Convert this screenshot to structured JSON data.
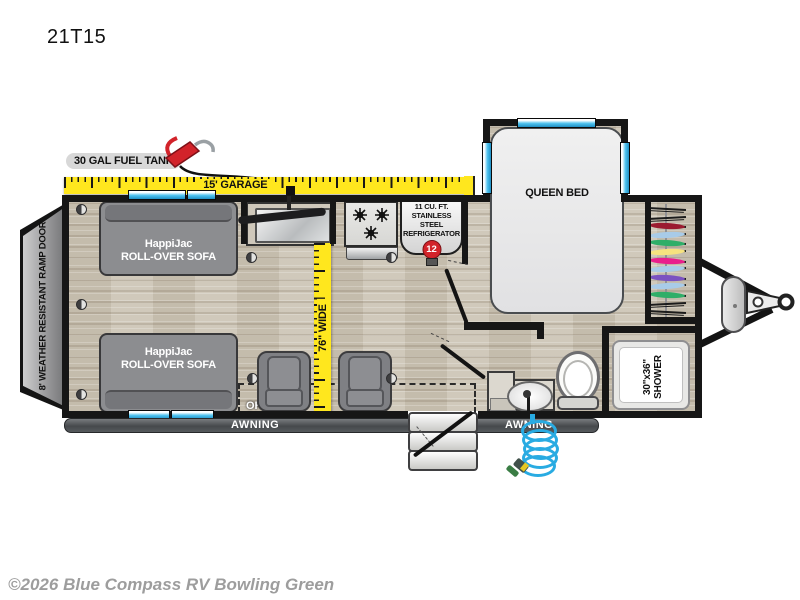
{
  "title": "21T15",
  "watermark": "©2026 Blue Compass RV Bowling Green",
  "exterior": {
    "fuel_tank_label": "30 GAL FUEL TANK",
    "garage_tape_label": "15' GARAGE",
    "ramp_door_label": "8' WEATHER RESISTANT RAMP DOOR",
    "awning_left_label": "AWNING",
    "awning_right_label": "AWNING"
  },
  "interior": {
    "width_tape_label": "76\" WIDE",
    "queen_bed_label": "QUEEN BED",
    "ohc_label": "OHC",
    "sofas": [
      {
        "line1": "HappiJac",
        "line2": "ROLL-OVER SOFA"
      },
      {
        "line1": "HappiJac",
        "line2": "ROLL-OVER SOFA"
      }
    ],
    "fridge": {
      "line1": "11 CU. FT.",
      "line2": "STAINLESS STEEL",
      "line3": "REFRIGERATOR",
      "badge": "12"
    },
    "shower": {
      "line1": "30\"x36\"",
      "line2": "SHOWER"
    }
  },
  "icons": {
    "fuel_nozzle": "fuel-pump-nozzle-icon",
    "fridge_badge": "12-volt-icon",
    "stove": "three-burner-stove-icon",
    "propane": "propane-tank-icon",
    "hitch": "tongue-coupler-icon",
    "steps": "entry-steps-icon",
    "hose": "coiled-spray-hose-icon"
  },
  "colors": {
    "tape_yellow": "#FFE71E",
    "accent_red": "#D2232A",
    "window_blue": "#4FC3F0",
    "hose_blue": "#29ABE2",
    "wall_black": "#161616",
    "floor_tan": "#CDC5B6",
    "sofa_gray": "#8C8D90",
    "awning_gray": "#46494C",
    "watermark_gray": "#9D9D9D"
  },
  "closet": {
    "hanger_colors": [
      "hanger",
      "hanger",
      "#9B1B30",
      "#A8CBE8",
      "#2FAE68",
      "#F6E27F",
      "#E91E8C",
      "#A8CBE8",
      "#7B52C1",
      "#A8CBE8",
      "#2FAE68",
      "hanger",
      "hanger"
    ]
  }
}
